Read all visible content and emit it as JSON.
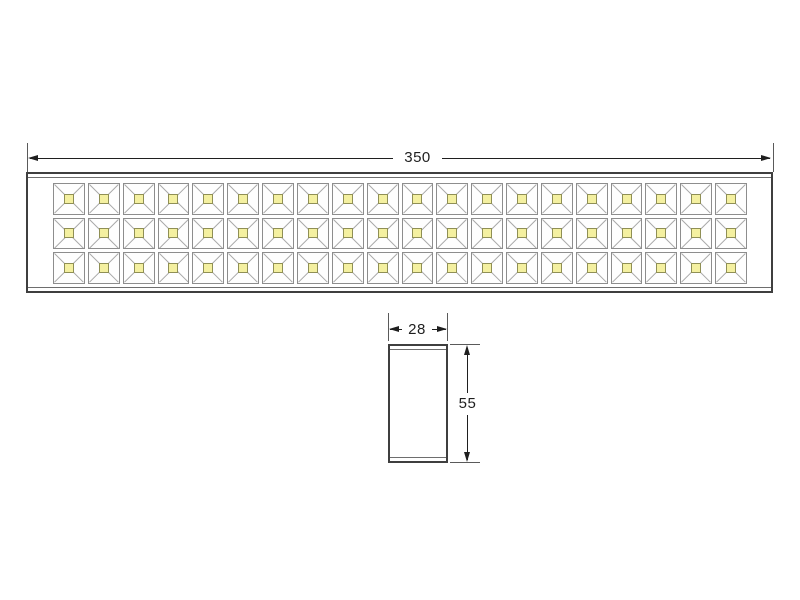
{
  "front_view": {
    "length_label": "350",
    "led_rows": 3,
    "led_columns": 20,
    "led_count": 60
  },
  "side_view": {
    "width_label": "28",
    "height_label": "55"
  },
  "colors": {
    "background": "#ffffff",
    "outline": "#3f3f3f",
    "dimension": "#1f1f1f",
    "cell_border": "#8d8d8d",
    "diagonal": "#a8a8a8",
    "led_fill": "#f4f0a0",
    "led_border": "#8f8f55"
  }
}
